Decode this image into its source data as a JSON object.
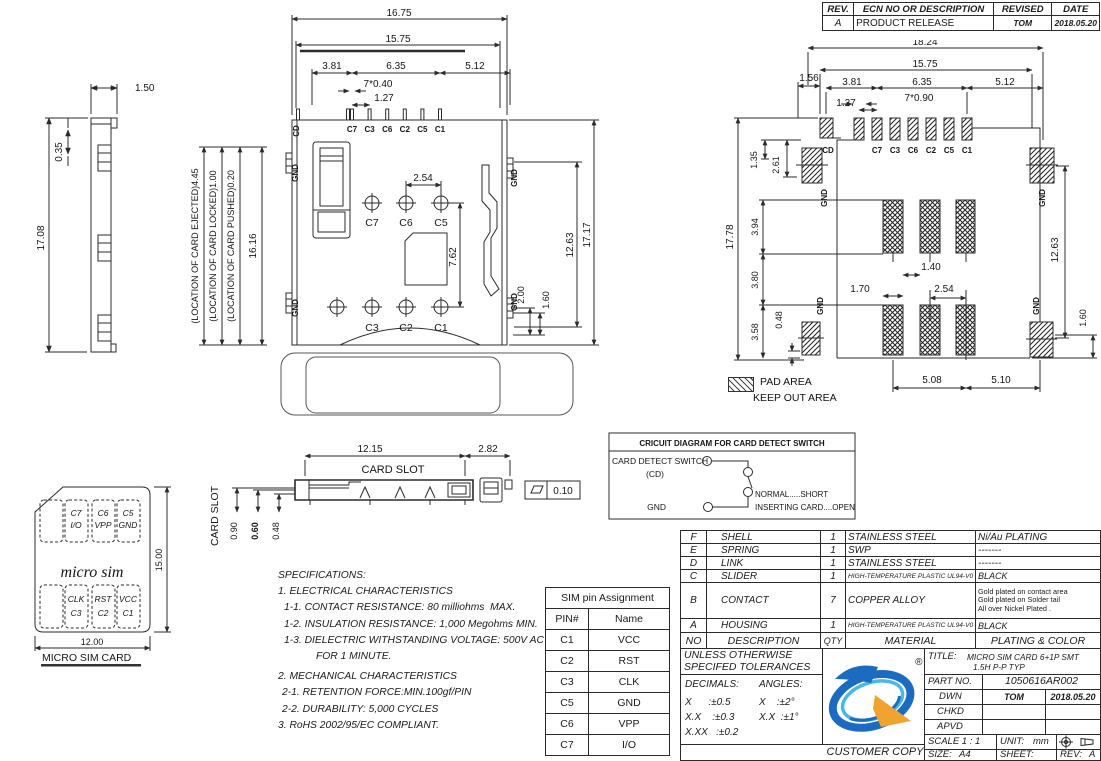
{
  "revision": {
    "h_rev": "REV.",
    "h_desc": "ECN NO OR DESCRIPTION",
    "h_revised": "REVISED",
    "h_date": "DATE",
    "rev": "A",
    "desc": "PRODUCT RELEASE",
    "revised": "TOM",
    "date": "2018.05.20"
  },
  "side_view": {
    "d_w": "1.50",
    "d_step": "0.35",
    "d_h": "17.08"
  },
  "location_dims": {
    "ejected": "(LOCATION OF CARD EJECTED)4.45",
    "locked": "(LOCATION OF CARD LOCKED)1.00",
    "pushed": "(LOCATION OF CARD PUSHED)0.20",
    "d_len": "16.16"
  },
  "front_view": {
    "d_total_w": "16.75",
    "d_shell_w": "15.75",
    "d_left": "3.81",
    "d_mid": "6.35",
    "d_right": "5.12",
    "d_pins": "7*0.40",
    "d_pitch": "1.27",
    "d_c6c5": "2.54",
    "d_rows": "7.62",
    "d_tail1": "2.00",
    "d_tail2": "1.60",
    "d_h1": "12.63",
    "d_h2": "17.17",
    "cd": "CD",
    "gnd": "GND",
    "pins": [
      "C7",
      "C3",
      "C6",
      "C2",
      "C5",
      "C1"
    ],
    "upper": [
      "C7",
      "C6",
      "C5"
    ],
    "lower": [
      "C3",
      "C2",
      "C1"
    ]
  },
  "pcb": {
    "d_total_w": "18.24",
    "d_shell_w": "15.75",
    "d_left": "3.81",
    "d_mid": "6.35",
    "d_right": "5.12",
    "d_pads": "7*0.90",
    "d_pitch": "1.27",
    "d_cd_off": "1.56",
    "d_cd_h1": "1.35",
    "d_cd_h2": "2.61",
    "d_total_h": "17.78",
    "d_k1": "3.94",
    "d_k2": "3.80",
    "d_k3": "3.58",
    "d_gnd_off": "0.48",
    "d_ko_w1": "1.70",
    "d_ko_w2": "1.40",
    "d_ko_pitch": "2.54",
    "d_b1": "5.08",
    "d_b2": "5.10",
    "d_h1": "12.63",
    "d_tail": "1.60",
    "cd": "CD",
    "gnd": "GND",
    "pins": [
      "C7",
      "C3",
      "C6",
      "C2",
      "C5",
      "C1"
    ],
    "legend_pad": "PAD AREA",
    "legend_keepout": "KEEP OUT AREA",
    "caption": "RECOMMENDED PCB LAYOUT",
    "tol": "GENERAL TOLERANCE ±0.05"
  },
  "card_slot": {
    "d_len": "12.15",
    "d_tail": "2.82",
    "label": "CARD SLOT",
    "side_label": "CARD SLOT",
    "d1": "0.90",
    "d2": "0.60",
    "d3": "0.48",
    "flatness": "0.10"
  },
  "circuit": {
    "title": "CRICUIT DIAGRAM FOR CARD DETECT SWITCH",
    "switch_label": "CARD DETECT SWITCH",
    "cd": "(CD)",
    "gnd": "GND",
    "normal": "NORMAL.....SHORT",
    "inserting": "INSERTING CARD....OPEN"
  },
  "sim_card": {
    "c7": "C7",
    "io": "I/O",
    "c6": "C6",
    "vpp": "VPP",
    "c5": "C5",
    "gnd": "GND",
    "clk": "CLK",
    "c3": "C3",
    "rst": "RST",
    "c2": "C2",
    "vcc": "VCC",
    "c1": "C1",
    "brand": "micro sim",
    "d_h": "15.00",
    "d_w": "12.00",
    "caption": "MICRO SIM CARD"
  },
  "specs": {
    "lines": [
      "SPECIFICATIONS:",
      "1. ELECTRICAL CHARACTERISTICS",
      "1-1. CONTACT RESISTANCE: 80 milliohms  MAX.",
      "1-2. INSULATION RESISTANCE: 1,000 Megohms MIN.",
      "1-3. DIELECTRIC WITHSTANDING VOLTAGE: 500V AC",
      "FOR 1 MINUTE.",
      "2. MECHANICAL CHARACTERISTICS",
      "2-1. RETENTION FORCE:MIN.100gf/PIN",
      "2-2. DURABILITY: 5,000 CYCLES",
      "3. RoHS 2002/95/EC COMPLIANT."
    ]
  },
  "pin_table": {
    "title": "SIM pin Assignment",
    "col1": "PIN#",
    "col2": "Name",
    "rows": [
      {
        "pin": "C1",
        "name": "VCC"
      },
      {
        "pin": "C2",
        "name": "RST"
      },
      {
        "pin": "C3",
        "name": "CLK"
      },
      {
        "pin": "C5",
        "name": "GND"
      },
      {
        "pin": "C6",
        "name": "VPP"
      },
      {
        "pin": "C7",
        "name": "I/O"
      }
    ]
  },
  "parts": {
    "h_no": "NO",
    "h_desc": "DESCRIPTION",
    "h_qty": "QTY",
    "h_mat": "MATERIAL",
    "h_plat": "PLATING & COLOR",
    "rows": [
      {
        "no": "F",
        "desc": "SHELL",
        "qty": "1",
        "mat": "STAINLESS STEEL",
        "plating": "Ni/Au PLATING"
      },
      {
        "no": "E",
        "desc": "SPRING",
        "qty": "1",
        "mat": "SWP",
        "plating": "-------"
      },
      {
        "no": "D",
        "desc": "LINK",
        "qty": "1",
        "mat": "STAINLESS STEEL",
        "plating": "-------"
      },
      {
        "no": "C",
        "desc": "SLIDER",
        "qty": "1",
        "mat": "HIGH-TEMPERATURE PLASTIC UL94-V0",
        "plating": "BLACK"
      },
      {
        "no": "B",
        "desc": "CONTACT",
        "qty": "7",
        "mat": "COPPER ALLOY",
        "plating": "Gold plated on contact area\nGold plated on Solder tail\nAll over Nickel Plated ."
      },
      {
        "no": "A",
        "desc": "HOUSING",
        "qty": "1",
        "mat": "HIGH-TEMPERATURE PLASTIC UL94-V0",
        "plating": "BLACK"
      }
    ]
  },
  "tb": {
    "tol1": "UNLESS OTHERWISE",
    "tol2": "SPECIFED TOLERANCES",
    "dec": "DECIMALS:",
    "ang": "ANGLES:",
    "dx1": "X      :±0.5",
    "ax1": "X    :±2°",
    "dx2": "X.X    :±0.3",
    "ax2": "X.X  :±1°",
    "dx3": "X.XX   :±0.2",
    "customer": "CUSTOMER COPY",
    "title_label": "TITLE:",
    "title1": "MICRO SIM CARD 6+1P SMT",
    "title2": "1.5H P-P TYP",
    "partno_label": "PART NO.",
    "partno": "1050616AR002",
    "dwn": "DWN",
    "dwn_v": "TOM",
    "date": "2018.05.20",
    "chkd": "CHKD",
    "apvd": "APVD",
    "scale": "SCALE 1 : 1",
    "unit_label": "UNIT:",
    "unit": "mm",
    "size_label": "SIZE:",
    "size": "A4",
    "sheet": "SHEET: 1OF1",
    "rev_label": "REV:",
    "rev": "A",
    "reg": "®"
  },
  "colors": {
    "line": "#2b2b2b",
    "logo_blue": "#1b6cc0",
    "logo_lightblue": "#49b8e8",
    "logo_orange": "#f0a32f"
  }
}
